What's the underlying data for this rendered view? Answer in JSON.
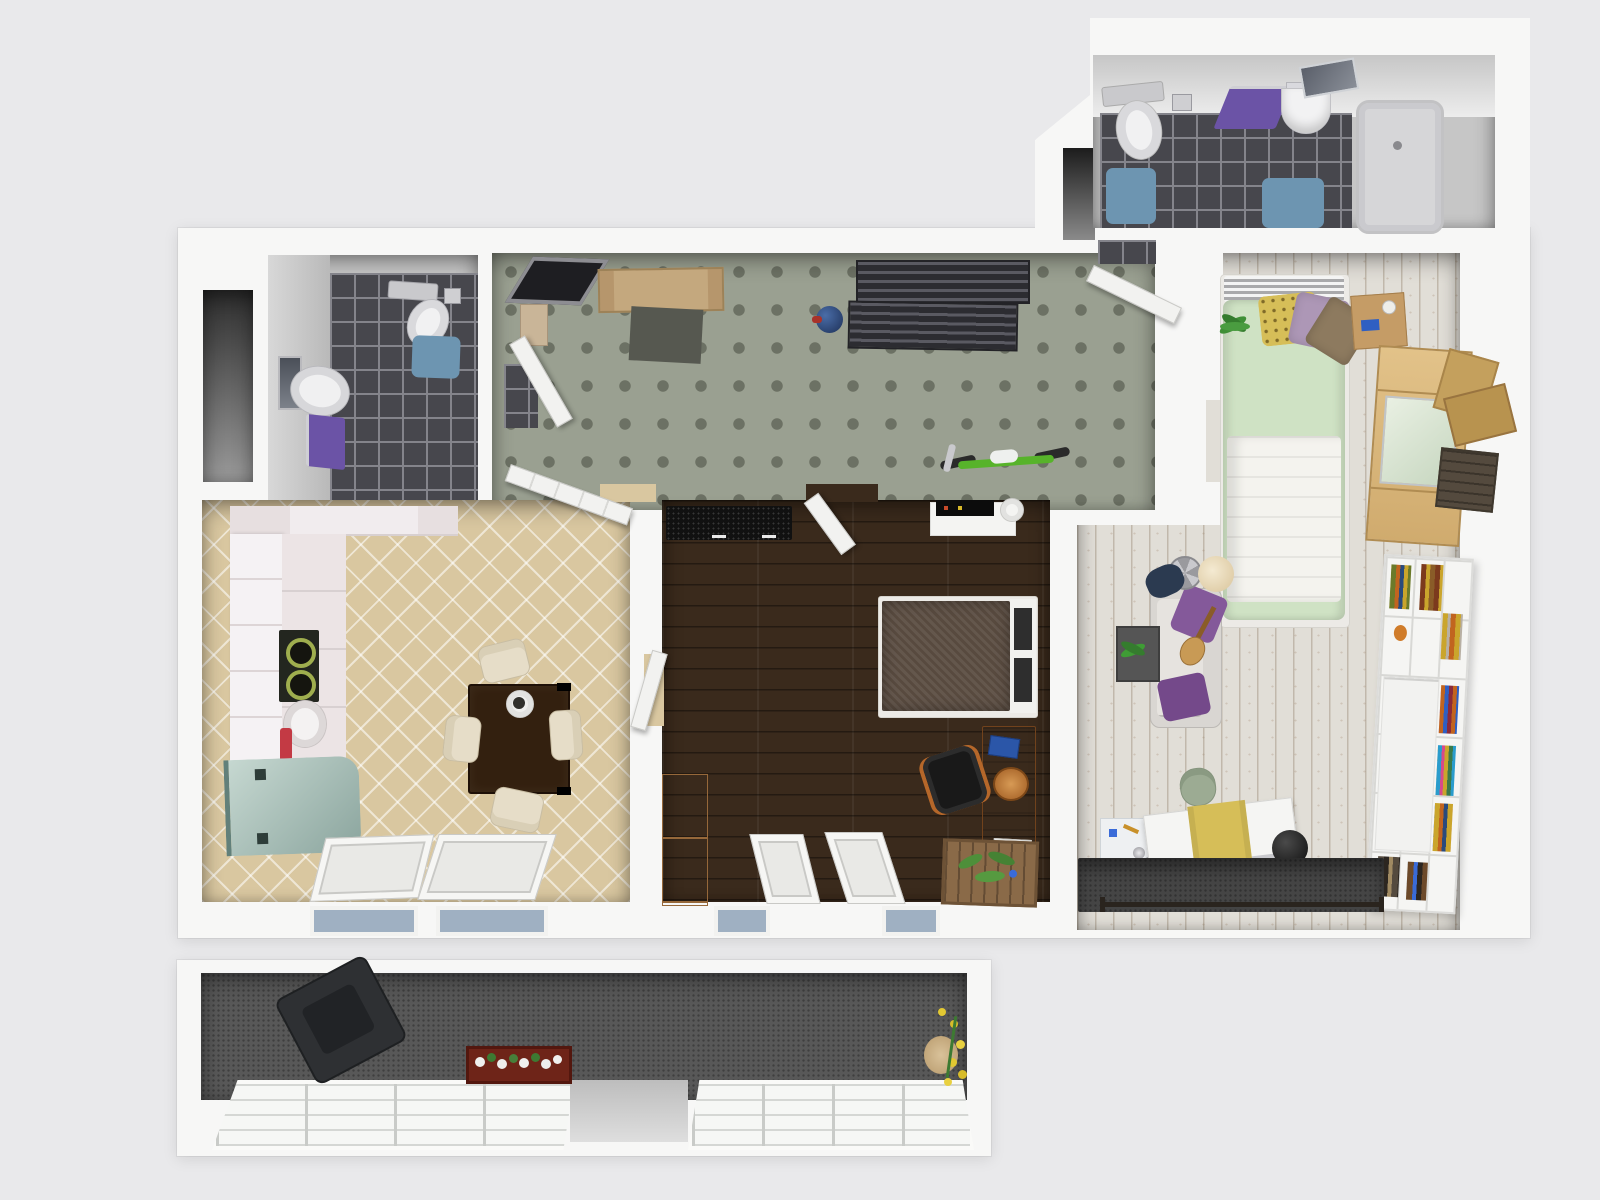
{
  "scene": {
    "type": "3d-apartment-floor-plan-render",
    "view": "top-down",
    "background": "#e9e9eb",
    "wall_color": "#f7f7f6"
  },
  "palette": {
    "bg": "#e9e9eb",
    "wall": "#f7f7f6",
    "tileDark": "#47474d",
    "tileGrout": "#84848b",
    "matBlue": "#6d95b1",
    "towelPurple": "#6b53a6",
    "hallCarpet": "#9aa091",
    "hallDot": "#6c7164",
    "kitchenFloor": "#d9c7a0",
    "bedroomFloor": "#3a2a1c",
    "rightFloor": "#e1ded7",
    "balconyFloor": "#585858",
    "nookDark": "#3c3c3c",
    "counterWhite": "#f1ecee",
    "cabinetWhite": "#f5f2f4",
    "applianceTeal": "#a9c3bb",
    "stoveDark": "#23261f",
    "accentRed": "#c33a44",
    "tableDark": "#33200f",
    "chairCream": "#e6ddc8",
    "doorWhite": "#f2f2f0",
    "sideboardBlack": "#111111",
    "woodDesk": "#9c5f2a",
    "woodCabinet": "#c89a5e",
    "woodCrate": "#8a6a48",
    "woodDoorTan": "#c4a87e",
    "bedBlanketDark": "#584a3f",
    "bedFrameWhite": "#eceae6",
    "duvetGreen": "#cfe2c4",
    "blanketWhite": "#f4f3ee",
    "pillowYellow": "#d6be58",
    "pillowPurple": "#ad97b6",
    "pillowBrown": "#8d7a5f",
    "woodBeech": "#dcba7e",
    "nightstandWood": "#c59c66",
    "boxTan": "#c4a05d",
    "boxTan2": "#b8934f",
    "boxDark": "#544a3e",
    "shelfWhite": "#f5f5f3",
    "sofaGrey": "#d9d6d2",
    "sofaPillow1": "#84599a",
    "sofaPillow2": "#74498a",
    "rugDark": "#454545",
    "matGrey": "#565850",
    "chairSage": "#9cab93",
    "lampBeige": "#eadfc4",
    "fanSilver": "#c9c9cd",
    "jacketNavy": "#2b3a50",
    "plantGreen": "#3f8f36",
    "bikeGreen": "#57b32a",
    "ballBlue": "#2c4a7c",
    "flowerYellow": "#e2c832",
    "flowerWhite": "#f0f0ee",
    "planterRed": "#6e2418",
    "glassBlue": "#9fb0c2",
    "bathtubGrey": "#d6d6d8",
    "armchairDark": "#2e3033",
    "deskChairBlack": "#191919",
    "laptopScreenBlue": "#2f74c0"
  },
  "rooms": {
    "bathroom_large": {
      "label": "large bathroom (top right)",
      "floor": "dark grey tiles"
    },
    "bathroom_small": {
      "label": "small bathroom (top left)",
      "floor": "dark grey tiles"
    },
    "hallway": {
      "label": "entry hallway",
      "floor": "green-grey carpet with dot grid"
    },
    "kitchen": {
      "label": "kitchen / dining",
      "floor": "beige diamond tiles"
    },
    "bedroom": {
      "label": "bedroom (center)",
      "floor": "dark walnut planks"
    },
    "living_room": {
      "label": "living / second bedroom (right, L-shaped)",
      "floor": "whitewashed planks"
    },
    "balcony": {
      "label": "balcony (bottom)",
      "floor": "dark grey outdoor carpet"
    },
    "storage_niche": {
      "label": "dark storage niche",
      "floor": "shadowed"
    }
  },
  "furniture": {
    "bathroom_large": [
      "toilet",
      "toilet-paper-holder",
      "purple-towel",
      "glass-shelf",
      "washbasin",
      "mirror",
      "blue-bath-mat",
      "blue-bath-mat-2",
      "bathtub"
    ],
    "bathroom_small": [
      "mirror",
      "washbasin",
      "purple-towel",
      "toilet",
      "toilet-paper-holder",
      "blue-bath-mat"
    ],
    "hallway": [
      "leaning-picture-frame",
      "storage-box",
      "entry-door",
      "grey-doormat",
      "blue-ball",
      "coat-rack-upper",
      "coat-rack-lower",
      "bicycle",
      "bathroom-door",
      "living-room-door",
      "small-bathroom-door"
    ],
    "kitchen": [
      "wall-counter",
      "tall-cabinets",
      "counter-run",
      "stove",
      "sink",
      "red-bottle",
      "teal-appliance",
      "dining-table",
      "plate",
      "chair-north",
      "chair-west",
      "chair-east",
      "chair-south",
      "tilted-window-1",
      "tilted-window-2",
      "window-sill-1",
      "window-sill-2",
      "kitchen-door"
    ],
    "bedroom": [
      "black-sideboard",
      "hall-door",
      "white-shelf",
      "stereo",
      "paper-roll",
      "double-bed",
      "dark-blanket",
      "headboard",
      "desk",
      "blue-book",
      "bread-basket",
      "laptop",
      "office-chair",
      "plant-crate",
      "tall-wardrobe",
      "tilted-window-1",
      "tilted-window-2",
      "window-sill-1",
      "window-sill-2",
      "kitchen-door"
    ],
    "living_room": [
      "single-bed",
      "metal-headboard",
      "green-duvet",
      "white-blanket",
      "yellow-pillow",
      "purple-pillow",
      "brown-pillow",
      "potted-plant",
      "nightstand",
      "beech-wardrobe",
      "cardboard-box-1",
      "cardboard-box-2",
      "dark-crate",
      "white-bookshelf",
      "bookshelf-doors",
      "books",
      "sofa",
      "sofa-pillow-1",
      "sofa-pillow-2",
      "guitar",
      "table-fan",
      "floor-lamp",
      "navy-jacket",
      "side-table-plant",
      "sage-chair",
      "art-cabinet",
      "drafting-board",
      "yellow-cloth",
      "exercise-ball",
      "grey-rug",
      "barbell-bar"
    ],
    "balcony": [
      "dark-armchair",
      "red-flower-box",
      "yellow-flowers",
      "terracotta-pot",
      "window-left",
      "window-right",
      "open-gap"
    ]
  }
}
